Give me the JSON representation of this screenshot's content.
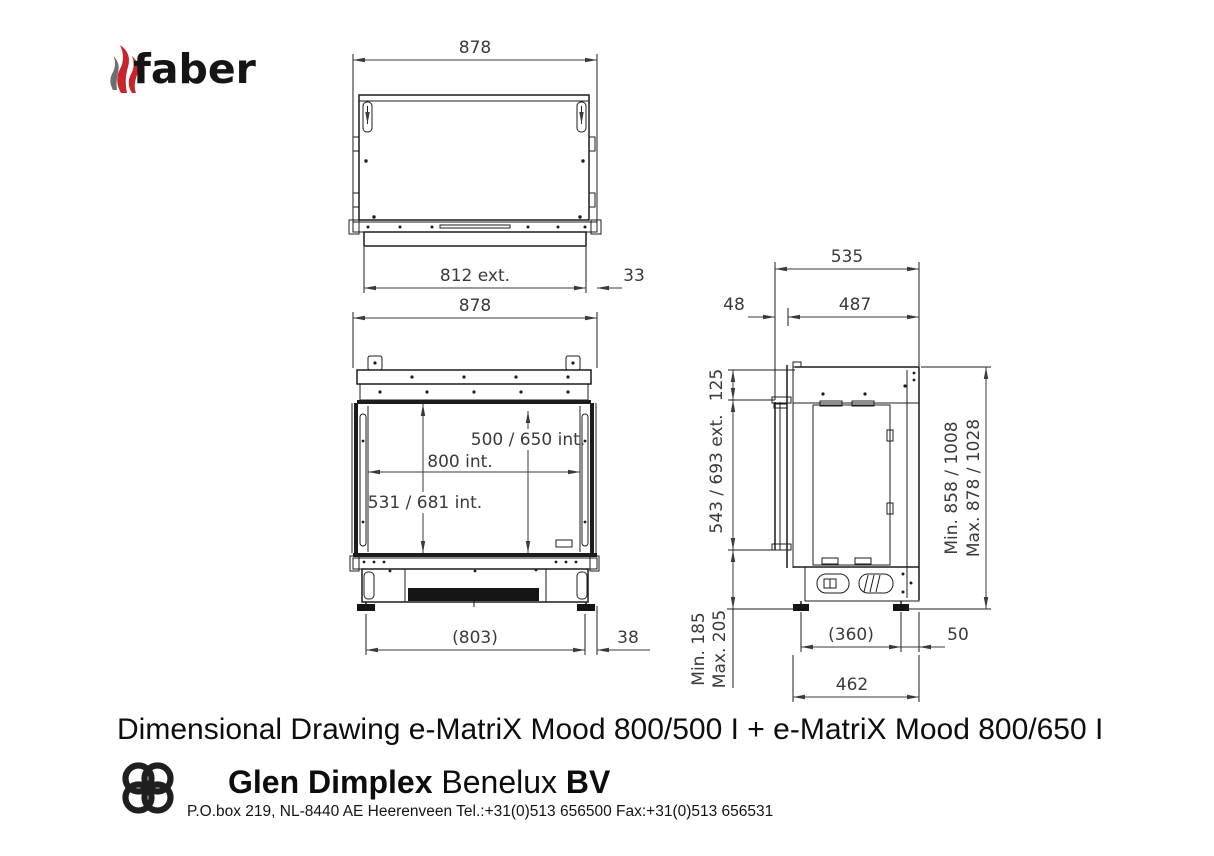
{
  "header": {
    "brand": "faber"
  },
  "views": {
    "top": {
      "dim_overall_width": "878",
      "dim_ext_width": "812 ext.",
      "dim_side_offset": "33"
    },
    "front": {
      "dim_overall_width": "878",
      "dim_inner_height": "500 / 650 int.",
      "dim_inner_width": "800 int.",
      "dim_inner_height_total": "531 / 681 int.",
      "dim_feet_span": "(803)",
      "dim_side_offset": "38"
    },
    "side": {
      "dim_overall_depth": "535",
      "dim_front_offset": "48",
      "dim_body_depth": "487",
      "dim_top_inset": "125",
      "dim_glass_height": "543 / 693 ext.",
      "dim_floor_min": "Min. 185",
      "dim_floor_max": "Max. 205",
      "dim_height_min": "Min. 858 / 1008",
      "dim_height_max": "Max. 878 / 1028",
      "dim_feet_span": "(360)",
      "dim_rear_offset": "50",
      "dim_base_depth": "462"
    }
  },
  "footer": {
    "title": "Dimensional Drawing e-MatriX Mood 800/500 I + e-MatriX Mood 800/650 I",
    "company_bold": "Glen Dimplex",
    "company_regular": " Benelux ",
    "company_suffix": "BV",
    "address": "P.O.box 219, NL-8440 AE Heerenveen Tel.:+31(0)513 656500  Fax:+31(0)513 656531"
  },
  "colors": {
    "line": "#1c1c1c",
    "dim_text": "#3a3a3a",
    "flame_red": "#c9242b",
    "flame_gray": "#6d6e71"
  }
}
